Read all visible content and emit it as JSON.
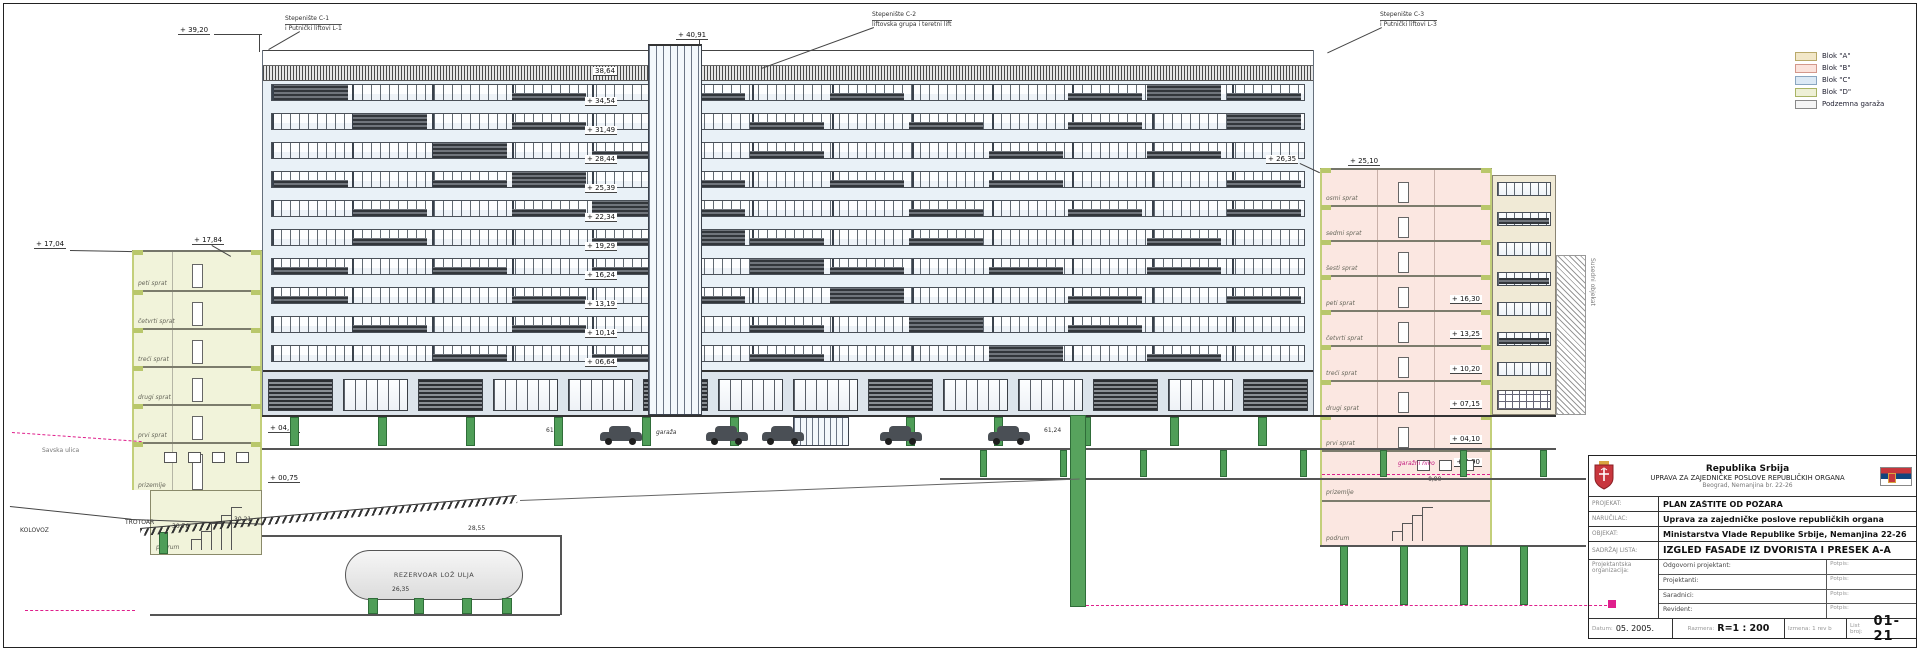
{
  "legend": {
    "items": [
      {
        "label": "Blok \"A\"",
        "color": "#f2e7c8",
        "border": "#b9a96a"
      },
      {
        "label": "Blok \"B\"",
        "color": "#fbe3dc",
        "border": "#d3988c"
      },
      {
        "label": "Blok \"C\"",
        "color": "#dce9f5",
        "border": "#8aa6c0"
      },
      {
        "label": "Blok \"D\"",
        "color": "#eef0d6",
        "border": "#a9b465"
      },
      {
        "label": "Podzemna garaža",
        "color": "#f4f4f4",
        "border": "#888888"
      }
    ]
  },
  "annotations": {
    "stairs": [
      {
        "line1": "Stepenište C-1",
        "line2": "i Putnički liftovi L-1"
      },
      {
        "line1": "Stepenište C-2",
        "line2": "liftovska grupa i teretni lift"
      },
      {
        "line1": "Stepenište C-3",
        "line2": "i Putnički liftovi L-3"
      }
    ],
    "roof_left": "+ 39,20",
    "roof_mid": "+ 40,91",
    "parapet_dim": "38,64",
    "right_top1": "+ 26,35",
    "right_top2": "+ 25,10",
    "neighbor": "Susedni objekat"
  },
  "facade": {
    "ladder": [
      "+ 34,54",
      "+ 31,49",
      "+ 28,44",
      "+ 25,39",
      "+ 22,34",
      "+ 19,29",
      "+ 16,24",
      "+ 13,19",
      "+ 10,14",
      "+ 06,64"
    ],
    "garage_label": "garaža",
    "dim_left": "61,56",
    "dim_right": "61,24"
  },
  "left_block": {
    "floors": [
      {
        "label": "peti sprat",
        "tag": ""
      },
      {
        "label": "četvrti sprat",
        "tag": ""
      },
      {
        "label": "treći sprat",
        "tag": ""
      },
      {
        "label": "drugi sprat",
        "tag": ""
      },
      {
        "label": "prvi sprat",
        "tag": "+ 04,10"
      },
      {
        "label": "prizemlje",
        "tag": "+ 00,75"
      }
    ],
    "basement": "podrum",
    "top_tag": "+ 17,84",
    "top_left_tag": "+ 17,04",
    "street": {
      "kolovoz": "KOLOVOZ",
      "trotoar": "TROTOAR",
      "name": "Savska ulica",
      "dim1": "30,76",
      "dim2": "30,21"
    }
  },
  "right_block": {
    "floors": [
      {
        "label": "osmi sprat",
        "tag": ""
      },
      {
        "label": "sedmi sprat",
        "tag": ""
      },
      {
        "label": "šesti sprat",
        "tag": ""
      },
      {
        "label": "peti sprat",
        "tag": "+ 16,30"
      },
      {
        "label": "četvrti sprat",
        "tag": "+ 13,25"
      },
      {
        "label": "treći sprat",
        "tag": "+ 10,20"
      },
      {
        "label": "drugi sprat",
        "tag": "+ 07,15"
      },
      {
        "label": "prvi sprat",
        "tag": "+ 04,10"
      }
    ],
    "ground": {
      "label": "prizemlje",
      "tag": "+ 0,90"
    },
    "basement": "podrum",
    "garage_level": {
      "label": "garažni nivo",
      "tag": "- 0,90"
    }
  },
  "underground": {
    "tank_label": "REZERVOAR LOŽ ULJA",
    "tank_dim": "26,35",
    "slab_dim": "28,55"
  },
  "title_block": {
    "country": "Republika Srbija",
    "org": "UPRAVA ZA ZAJEDNIČKE POSLOVE REPUBLIČKIH ORGANA",
    "address": "Beograd, Nemanjina br. 22-26",
    "rows": [
      {
        "label": "PROJEKAT:",
        "value": "PLAN ZAŠTITE OD POŽARA"
      },
      {
        "label": "NARUČILAC:",
        "value": "Uprava za zajedničke poslove republičkih organa"
      },
      {
        "label": "OBJEKAT:",
        "value": "Ministarstva Vlade Republike Srbije, Nemanjina 22-26"
      },
      {
        "label": "SADRŽAJ LISTA:",
        "value": "IZGLED FASADE IZ DVORIŠTA I PRESEK A-A",
        "big": true
      }
    ],
    "org_label": "Projektantska organizacija:",
    "signature_rows": [
      {
        "label": "Odgovorni projektant:",
        "sign": "Potpis:"
      },
      {
        "label": "Projektanti:",
        "sign": "Potpis:"
      },
      {
        "label": "Saradnici:",
        "sign": "Potpis:"
      },
      {
        "label": "Revident:",
        "sign": "Potpis:"
      }
    ],
    "date_label": "Datum:",
    "date": "05. 2005.",
    "scale_label": "Razmera:",
    "scale": "R=1 : 200",
    "revision": "Izmena: 1 rev b",
    "sheet_label": "List broj:",
    "sheet_no": "01-21"
  }
}
